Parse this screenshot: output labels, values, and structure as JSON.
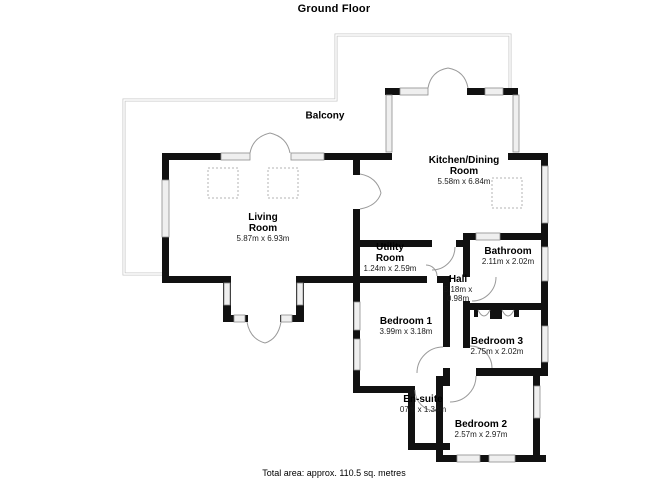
{
  "title": "Ground Floor",
  "footer": "Total area: approx. 110.5 sq. metres",
  "rooms": {
    "balcony": {
      "name": "Balcony"
    },
    "living": {
      "name": "Living Room",
      "dims": "5.87m x 6.93m"
    },
    "kitchen": {
      "name": "Kitchen/Dining Room",
      "dims": "5.58m x 6.84m"
    },
    "utility": {
      "name": "Utility Room",
      "dims": "1.24m x 2.59m"
    },
    "bathroom": {
      "name": "Bathroom",
      "dims": "2.11m x 2.02m"
    },
    "hall": {
      "name": "Hall",
      "dims": "5.18m x 0.98m"
    },
    "bedroom1": {
      "name": "Bedroom 1",
      "dims": "3.99m x 3.18m"
    },
    "bedroom3": {
      "name": "Bedroom 3",
      "dims": "2.75m x 2.02m"
    },
    "ensuite": {
      "name": "En-suite",
      "dims": "07m x 1.34m"
    },
    "bedroom2": {
      "name": "Bedroom 2",
      "dims": "2.57m x 2.97m"
    }
  },
  "colors": {
    "wall": "#111111",
    "window_fill": "#efefef",
    "window_stroke": "#8c8c8c",
    "door_arc": "#9a9a9a",
    "balcony_line": "#c9c9c9"
  }
}
